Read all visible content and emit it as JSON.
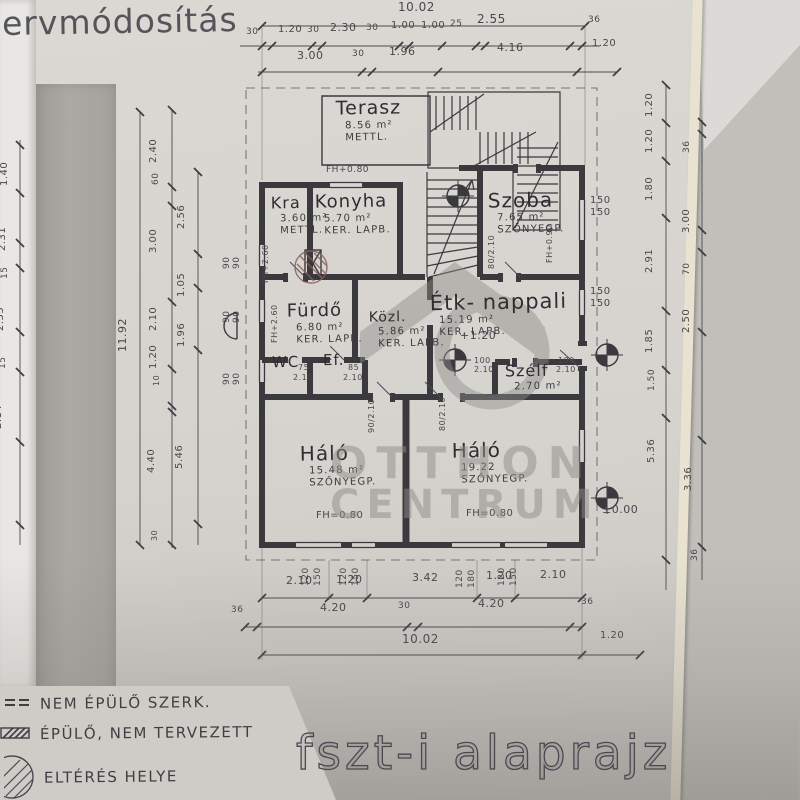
{
  "page": {
    "title_top": "ervmódosítás",
    "title_bottom": "fszt-i alaprajz"
  },
  "watermark": {
    "line1": "OTTHON",
    "line2": "CENTRUM"
  },
  "legend": {
    "items": [
      {
        "symbol": "double-line",
        "label": "NEM ÉPÜLŐ SZERK."
      },
      {
        "symbol": "hatched-bar",
        "label": "ÉPÜLŐ, NEM TERVEZETT"
      },
      {
        "symbol": "hatched-circle",
        "label": "ELTÉRÉS HELYE"
      }
    ]
  },
  "colors": {
    "paper": "#d6d3ce",
    "backdrop_gray": "#a9a6a1",
    "ink": "#3a393d",
    "dim_ink": "#4c4b4f",
    "watermark_gray": "#8f8d89",
    "edge_cream": "#e9e2d1",
    "deviation_red": "#8a5f58"
  },
  "plan": {
    "rooms": [
      {
        "name": "Terasz",
        "area": "8.56 m²",
        "floor": "METTL.",
        "x": 336,
        "y": 99,
        "ns": 19
      },
      {
        "name": "Kra",
        "area": "3.60 m²",
        "floor": "METTL.",
        "x": 271,
        "y": 195,
        "ns": 16
      },
      {
        "name": "Konyha",
        "area": "5.70 m²",
        "floor": "KER. LAPB.",
        "x": 315,
        "y": 193,
        "ns": 18
      },
      {
        "name": "Szoba",
        "area": "7.65 m²",
        "floor": "SZŐNYEGP.",
        "x": 488,
        "y": 190,
        "ns": 20
      },
      {
        "name": "Fürdő",
        "area": "6.80 m²",
        "floor": "KER. LAPB.",
        "x": 287,
        "y": 302,
        "ns": 18
      },
      {
        "name": "Közl.",
        "area": "5.86 m²",
        "floor": "KER. LAPB.",
        "x": 369,
        "y": 310,
        "ns": 14
      },
      {
        "name": "Étk- nappali",
        "area": "15.19 m²",
        "floor": "KER. LAPB.",
        "x": 430,
        "y": 291,
        "ns": 21
      },
      {
        "name": "WC",
        "area": "",
        "floor": "",
        "x": 272,
        "y": 355,
        "ns": 15
      },
      {
        "name": "Ef.",
        "area": "",
        "floor": "",
        "x": 323,
        "y": 353,
        "ns": 15
      },
      {
        "name": "Szélf",
        "area": "2.70 m²",
        "floor": "",
        "x": 505,
        "y": 363,
        "ns": 16
      },
      {
        "name": "Háló",
        "area": "15.48 m²",
        "floor": "SZŐNYEGP.",
        "x": 300,
        "y": 443,
        "ns": 20
      },
      {
        "name": "Háló",
        "area": "19.22",
        "floor": "SZŐNYEGP.",
        "x": 452,
        "y": 440,
        "ns": 20
      }
    ],
    "labels": [
      {
        "t": "10.02",
        "x": 398,
        "y": 12,
        "s": 12
      },
      {
        "t": "30",
        "x": 246,
        "y": 36,
        "s": 9
      },
      {
        "t": "1.20",
        "x": 278,
        "y": 34,
        "s": 10
      },
      {
        "t": "30",
        "x": 307,
        "y": 34,
        "s": 9
      },
      {
        "t": "2.30",
        "x": 330,
        "y": 32,
        "s": 11
      },
      {
        "t": "30",
        "x": 366,
        "y": 32,
        "s": 9
      },
      {
        "t": "1.00",
        "x": 391,
        "y": 30,
        "s": 10
      },
      {
        "t": "1.00",
        "x": 421,
        "y": 30,
        "s": 10
      },
      {
        "t": "25",
        "x": 450,
        "y": 28,
        "s": 9
      },
      {
        "t": "2.55",
        "x": 477,
        "y": 24,
        "s": 12
      },
      {
        "t": "36",
        "x": 588,
        "y": 24,
        "s": 9
      },
      {
        "t": "3.00",
        "x": 297,
        "y": 60,
        "s": 11
      },
      {
        "t": "30",
        "x": 352,
        "y": 58,
        "s": 9
      },
      {
        "t": "1.96",
        "x": 389,
        "y": 56,
        "s": 11
      },
      {
        "t": "4.16",
        "x": 497,
        "y": 52,
        "s": 11
      },
      {
        "t": "1.20",
        "x": 592,
        "y": 48,
        "s": 10
      },
      {
        "t": "2.10",
        "x": 286,
        "y": 585,
        "s": 11
      },
      {
        "t": "1.20",
        "x": 336,
        "y": 584,
        "s": 11
      },
      {
        "t": "3.42",
        "x": 412,
        "y": 582,
        "s": 11
      },
      {
        "t": "1.20",
        "x": 486,
        "y": 580,
        "s": 11
      },
      {
        "t": "2.10",
        "x": 540,
        "y": 579,
        "s": 11
      },
      {
        "t": "36",
        "x": 231,
        "y": 614,
        "s": 9
      },
      {
        "t": "4.20",
        "x": 320,
        "y": 612,
        "s": 11
      },
      {
        "t": "30",
        "x": 398,
        "y": 610,
        "s": 9
      },
      {
        "t": "4.20",
        "x": 478,
        "y": 608,
        "s": 11
      },
      {
        "t": "36",
        "x": 581,
        "y": 606,
        "s": 9
      },
      {
        "t": "10.02",
        "x": 402,
        "y": 644,
        "s": 12
      },
      {
        "t": "1.20",
        "x": 600,
        "y": 640,
        "s": 10
      },
      {
        "t": "120",
        "x": 311,
        "y": 585,
        "r": -90,
        "s": 9
      },
      {
        "t": "150",
        "x": 323,
        "y": 585,
        "r": -90,
        "s": 9
      },
      {
        "t": "120",
        "x": 349,
        "y": 585,
        "r": -90,
        "s": 9
      },
      {
        "t": "150",
        "x": 361,
        "y": 585,
        "r": -90,
        "s": 9
      },
      {
        "t": "120",
        "x": 465,
        "y": 587,
        "r": -90,
        "s": 9
      },
      {
        "t": "180",
        "x": 477,
        "y": 587,
        "r": -90,
        "s": 9
      },
      {
        "t": "120",
        "x": 507,
        "y": 585,
        "r": -90,
        "s": 9
      },
      {
        "t": "150",
        "x": 519,
        "y": 585,
        "r": -90,
        "s": 9
      },
      {
        "t": "1.40",
        "x": 10,
        "y": 185,
        "r": -90,
        "s": 10
      },
      {
        "t": "2.31",
        "x": 8,
        "y": 250,
        "r": -90,
        "s": 10
      },
      {
        "t": "15",
        "x": 10,
        "y": 278,
        "r": -90,
        "s": 9
      },
      {
        "t": "2.55",
        "x": 6,
        "y": 330,
        "r": -90,
        "s": 10
      },
      {
        "t": "15",
        "x": 8,
        "y": 368,
        "r": -90,
        "s": 9
      },
      {
        "t": "2.14",
        "x": 4,
        "y": 428,
        "r": -90,
        "s": 10
      },
      {
        "t": "2.51",
        "x": 2,
        "y": 495,
        "r": -90,
        "s": 10
      },
      {
        "t": "11.92",
        "x": 129,
        "y": 350,
        "r": -90,
        "s": 11
      },
      {
        "t": "2.40",
        "x": 159,
        "y": 162,
        "r": -90,
        "s": 10
      },
      {
        "t": "60",
        "x": 161,
        "y": 184,
        "r": -90,
        "s": 9
      },
      {
        "t": "3.00",
        "x": 159,
        "y": 252,
        "r": -90,
        "s": 10
      },
      {
        "t": "2.10",
        "x": 159,
        "y": 330,
        "r": -90,
        "s": 10
      },
      {
        "t": "1.20",
        "x": 159,
        "y": 368,
        "r": -90,
        "s": 10
      },
      {
        "t": "10",
        "x": 161,
        "y": 385,
        "r": -90,
        "s": 8
      },
      {
        "t": "4.40",
        "x": 157,
        "y": 472,
        "r": -90,
        "s": 10
      },
      {
        "t": "30",
        "x": 159,
        "y": 540,
        "r": -90,
        "s": 8
      },
      {
        "t": "2.56",
        "x": 187,
        "y": 228,
        "r": -90,
        "s": 10
      },
      {
        "t": "1.05",
        "x": 187,
        "y": 296,
        "r": -90,
        "s": 10
      },
      {
        "t": "1.96",
        "x": 187,
        "y": 346,
        "r": -90,
        "s": 10
      },
      {
        "t": "5.46",
        "x": 185,
        "y": 468,
        "r": -90,
        "s": 10
      },
      {
        "t": "1.20",
        "x": 655,
        "y": 116,
        "r": -90,
        "s": 10
      },
      {
        "t": "1.20",
        "x": 655,
        "y": 152,
        "r": -90,
        "s": 10
      },
      {
        "t": "1.80",
        "x": 655,
        "y": 200,
        "r": -90,
        "s": 10
      },
      {
        "t": "2.91",
        "x": 655,
        "y": 272,
        "r": -90,
        "s": 10
      },
      {
        "t": "1.85",
        "x": 655,
        "y": 352,
        "r": -90,
        "s": 10
      },
      {
        "t": "1.50",
        "x": 657,
        "y": 390,
        "r": -90,
        "s": 9
      },
      {
        "t": "5.36",
        "x": 657,
        "y": 462,
        "r": -90,
        "s": 10
      },
      {
        "t": "36",
        "x": 692,
        "y": 152,
        "r": -90,
        "s": 9
      },
      {
        "t": "3.00",
        "x": 692,
        "y": 232,
        "r": -90,
        "s": 10
      },
      {
        "t": "70",
        "x": 692,
        "y": 274,
        "r": -90,
        "s": 9
      },
      {
        "t": "2.50",
        "x": 692,
        "y": 332,
        "r": -90,
        "s": 10
      },
      {
        "t": "3.36",
        "x": 694,
        "y": 490,
        "r": -90,
        "s": 10
      },
      {
        "t": "36",
        "x": 700,
        "y": 560,
        "r": -90,
        "s": 9
      },
      {
        "t": "150",
        "x": 590,
        "y": 205,
        "s": 10
      },
      {
        "t": "150",
        "x": 590,
        "y": 217,
        "s": 10
      },
      {
        "t": "150",
        "x": 590,
        "y": 296,
        "s": 10
      },
      {
        "t": "150",
        "x": 590,
        "y": 308,
        "s": 10
      },
      {
        "t": "FH+0.80",
        "x": 326,
        "y": 174,
        "s": 9
      },
      {
        "t": "FH=0.80",
        "x": 316,
        "y": 520,
        "s": 10
      },
      {
        "t": "FH=0.80",
        "x": 466,
        "y": 518,
        "s": 10
      },
      {
        "t": "+1.20",
        "x": 460,
        "y": 340,
        "s": 11
      },
      {
        "t": "±0.00",
        "x": 602,
        "y": 514,
        "s": 11
      },
      {
        "t": "FH+0.90",
        "x": 554,
        "y": 262,
        "r": -90,
        "s": 8
      },
      {
        "t": "FH+2.60",
        "x": 270,
        "y": 282,
        "r": -90,
        "s": 8
      },
      {
        "t": "FH+2.60",
        "x": 279,
        "y": 342,
        "r": -90,
        "s": 8
      },
      {
        "t": "75",
        "x": 298,
        "y": 371,
        "s": 8
      },
      {
        "t": "2.10",
        "x": 293,
        "y": 381,
        "s": 8
      },
      {
        "t": "85",
        "x": 348,
        "y": 371,
        "s": 8
      },
      {
        "t": "2.10",
        "x": 343,
        "y": 381,
        "s": 8
      },
      {
        "t": "100",
        "x": 474,
        "y": 364,
        "s": 8
      },
      {
        "t": "2.10",
        "x": 474,
        "y": 373,
        "s": 8
      },
      {
        "t": "100",
        "x": 558,
        "y": 364,
        "s": 8
      },
      {
        "t": "2.10",
        "x": 556,
        "y": 373,
        "s": 8
      },
      {
        "t": "90/2.10",
        "x": 376,
        "y": 432,
        "r": -90,
        "s": 8
      },
      {
        "t": "80/2.10",
        "x": 447,
        "y": 430,
        "r": -90,
        "s": 8
      },
      {
        "t": "80/2.10",
        "x": 496,
        "y": 268,
        "r": -90,
        "s": 8
      },
      {
        "t": "90",
        "x": 232,
        "y": 268,
        "r": -90,
        "s": 9
      },
      {
        "t": "90",
        "x": 242,
        "y": 268,
        "r": -90,
        "s": 9
      },
      {
        "t": "90",
        "x": 232,
        "y": 322,
        "r": -90,
        "s": 9
      },
      {
        "t": "90",
        "x": 242,
        "y": 322,
        "r": -90,
        "s": 9
      },
      {
        "t": "90",
        "x": 232,
        "y": 384,
        "r": -90,
        "s": 9
      },
      {
        "t": "90",
        "x": 242,
        "y": 384,
        "r": -90,
        "s": 9
      }
    ]
  }
}
